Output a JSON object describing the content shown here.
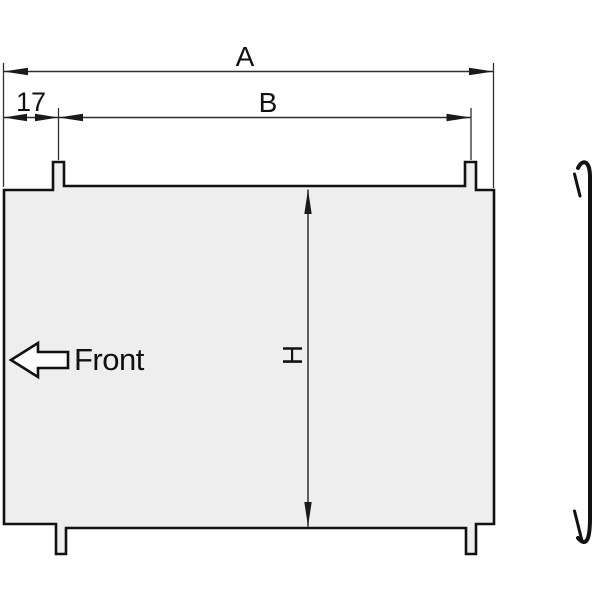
{
  "colors": {
    "background": "#ffffff",
    "panel_fill": "#eeeeee",
    "line": "#1a1a1a",
    "front_arrow_fill": "#ffffff"
  },
  "labels": {
    "dim_overall_width": "A",
    "dim_tab_span": "B",
    "dim_tab_offset": "17",
    "dim_height": "H",
    "front": "Front"
  }
}
